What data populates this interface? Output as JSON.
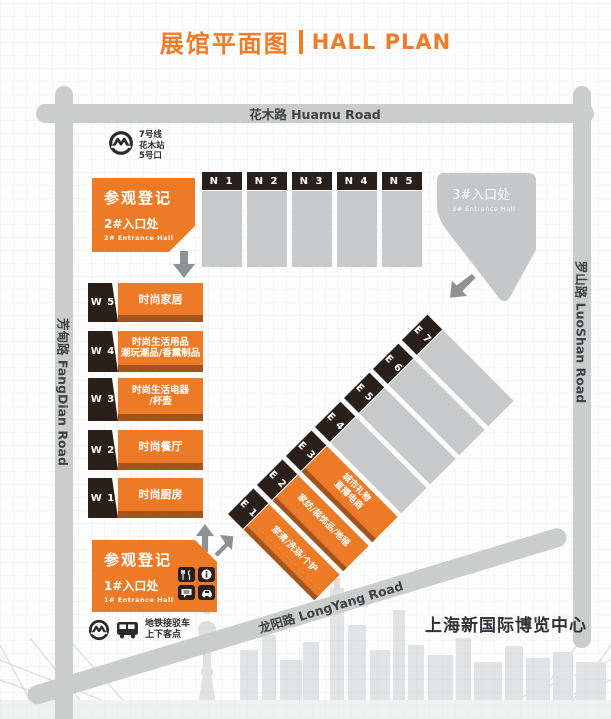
{
  "title": {
    "cn": "展馆平面图",
    "en": "HALL PLAN"
  },
  "roads": {
    "top": "花木路 Huamu Road",
    "left": "芳甸路 FangDian Road",
    "right": "罗山路 LuoShan Road",
    "bottom": "龙阳路 LongYang Road"
  },
  "metro_station": {
    "lines": [
      "7号线",
      "花木站",
      "5号口"
    ]
  },
  "entrance2": {
    "title": "参观登记",
    "hall_cn": "2#入口处",
    "hall_en": "2# Entrance Hall"
  },
  "entrance3": {
    "hall_cn": "3#入口处",
    "hall_en": "3# Entrance Hall"
  },
  "entrance1": {
    "title": "参观登记",
    "hall_cn": "1#入口处",
    "hall_en": "1# Entrance Hall"
  },
  "shuttle": {
    "lines": [
      "地铁接驳车",
      "上下客点"
    ]
  },
  "venue_name": "上海新国际博览中心",
  "n_halls": [
    "N 1",
    "N 2",
    "N 3",
    "N 4",
    "N 5"
  ],
  "w_halls": [
    {
      "code": "W 5",
      "lines": [
        "时尚家居"
      ]
    },
    {
      "code": "W 4",
      "lines": [
        "时尚生活用品",
        "潮玩潮品/香薰制品"
      ]
    },
    {
      "code": "W 3",
      "lines": [
        "时尚生活电器",
        "/杯壶"
      ]
    },
    {
      "code": "W 2",
      "lines": [
        "时尚餐厅"
      ]
    },
    {
      "code": "W 1",
      "lines": [
        "时尚厨房"
      ]
    }
  ],
  "e_halls": [
    {
      "code": "E 1",
      "lines": [
        "家清/洗涤/个护"
      ],
      "type": "orange"
    },
    {
      "code": "E 2",
      "lines": [
        "家纺/装饰品/地毯"
      ],
      "type": "orange"
    },
    {
      "code": "E 3",
      "lines": [
        "城市礼物",
        "直播电商"
      ],
      "type": "orange"
    },
    {
      "code": "E 4",
      "lines": [],
      "type": "gray"
    },
    {
      "code": "E 5",
      "lines": [],
      "type": "gray"
    },
    {
      "code": "E 6",
      "lines": [],
      "type": "gray"
    },
    {
      "code": "E 7",
      "lines": [],
      "type": "gray"
    }
  ],
  "service_icons": [
    "restaurant-icon",
    "info-icon",
    "consult-icon",
    "taxi-icon"
  ],
  "colors": {
    "accent_orange": "#ee7c28",
    "hall_orange": "#ec7a26",
    "hall_orange_edge": "#a3541e",
    "hall_dark": "#2b2019",
    "hall_gray": "#c8c9ca",
    "road_gray": "#cbcccc",
    "arrow_gray": "#8f9294"
  }
}
